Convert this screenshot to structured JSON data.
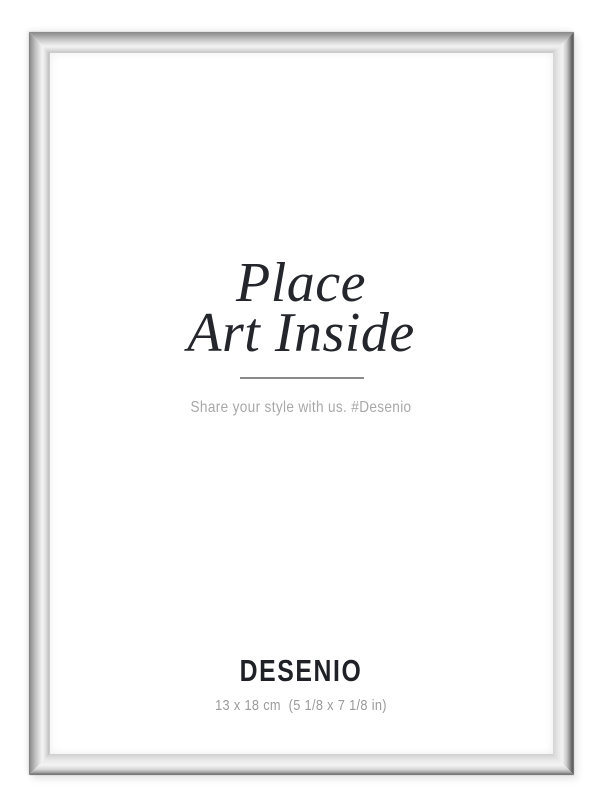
{
  "product": {
    "insert": {
      "title_line1": "Place",
      "title_line2": "Art Inside",
      "tagline": "Share your style with us. #Desenio",
      "brand": "DESENIO",
      "dimensions": "13 x 18 cm  (5 1/8 x 7 1/8 in)"
    },
    "frame": {
      "style": "thin silver metal frame",
      "colors": {
        "silver_light": "#f2f2f2",
        "silver_mid": "#c9c9c9",
        "silver_dark": "#8a8a8a",
        "edge_dark": "#5c5c5c"
      }
    },
    "colors": {
      "background": "#ffffff",
      "title_text": "#24262b",
      "brand_text": "#1f2126",
      "tagline_text": "#a8a8a8",
      "dimensions_text": "#9b9b9b",
      "divider": "#8a8a8a"
    }
  }
}
